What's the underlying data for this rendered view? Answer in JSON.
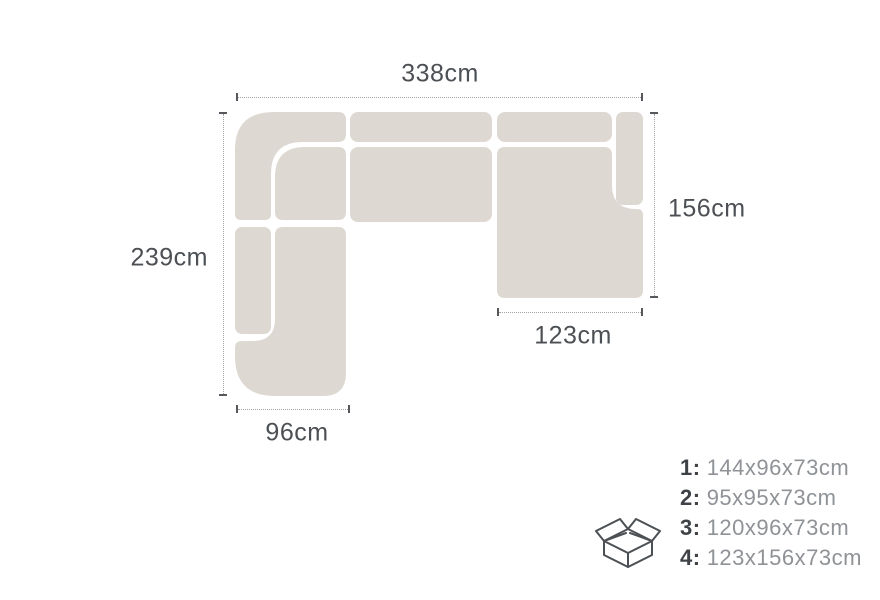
{
  "diagram": {
    "title": "sofa-dimension-top-view",
    "dimensions": {
      "top": "338cm",
      "left": "239cm",
      "right": "156cm",
      "bottom_left": "96cm",
      "bottom_right": "123cm"
    },
    "legend": {
      "icon": "open-box-icon",
      "items": [
        {
          "num": "1:",
          "dims": "144x96x73cm"
        },
        {
          "num": "2:",
          "dims": "95x95x73cm"
        },
        {
          "num": "3:",
          "dims": "120x96x73cm"
        },
        {
          "num": "4:",
          "dims": "123x156x73cm"
        }
      ]
    },
    "colors": {
      "background": "#ffffff",
      "sofa_fill": "#ddd8d1",
      "dim_text": "#4c5054",
      "dim_tick": "#55585c",
      "dim_dots": "#a3a3a3",
      "legend_num": "#3f4347",
      "legend_dims": "#8f9296"
    }
  }
}
